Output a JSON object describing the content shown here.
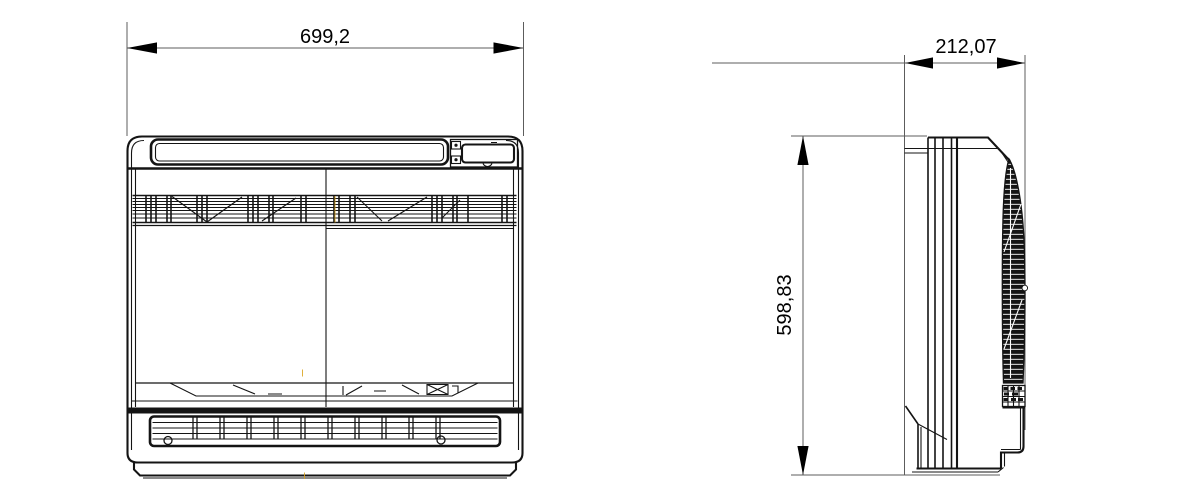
{
  "drawing": {
    "kind": "dimensional technical drawing, front and side orthographic views of a floor-console air conditioning unit"
  },
  "dimensions": {
    "width": {
      "label": "699,2",
      "value": 699.2
    },
    "depth": {
      "label": "212,07",
      "value": 212.07
    },
    "height": {
      "label": "598,83",
      "value": 598.83
    }
  },
  "colors": {
    "background": "#ffffff",
    "drawing_line": "#141414",
    "dimension_line": "#5c5c5c",
    "text": "#000000",
    "centerline_accent": "#d9a21b"
  }
}
